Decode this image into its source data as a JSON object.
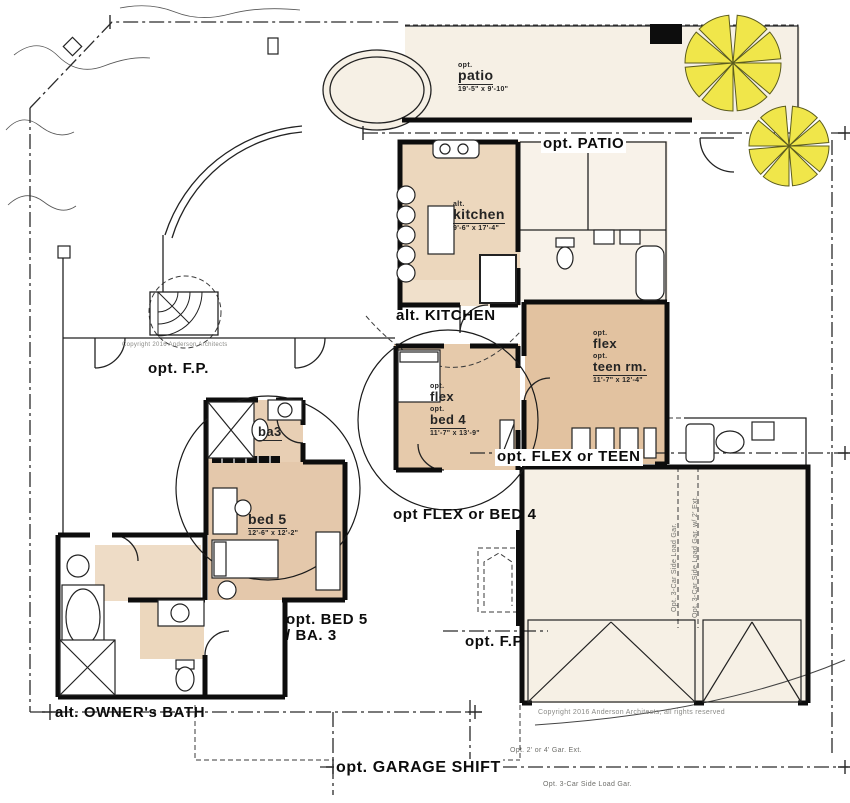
{
  "colors": {
    "tan": "#e4c8ab",
    "tan_light": "#eedcc6",
    "cream": "#f6f0e5",
    "line": "#111111",
    "tree_yellow": "#f0e64a",
    "note_gray": "#8a8a86"
  },
  "rooms": {
    "patio": {
      "prefix": "opt.",
      "name": "patio",
      "dims": "19'-5\" x 9'-10\""
    },
    "kitchen": {
      "prefix": "alt.",
      "name": "kitchen",
      "dims": "9'-6\" x 17'-4\""
    },
    "flex_teen": {
      "prefix1": "opt.",
      "line1": "flex",
      "prefix2": "opt.",
      "line2": "teen rm.",
      "dims": "11'-7\" x 12'-4\""
    },
    "flex_bed4": {
      "prefix1": "opt.",
      "line1": "flex",
      "prefix2": "opt.",
      "line2": "bed 4",
      "dims": "11'-7\" x 13'-9\""
    },
    "ba3": {
      "name": "ba3"
    },
    "bed5": {
      "name": "bed 5",
      "dims": "12'-6\" x 12'-2\""
    }
  },
  "callouts": {
    "patio": "opt. PATIO",
    "kitchen": "alt. KITCHEN",
    "fp_left": "opt. F.P.",
    "flex_teen": "opt. FLEX or TEEN",
    "flex_bed4": "opt FLEX or BED 4",
    "bed5_line1": "opt. BED 5",
    "bed5_line2": "/ BA. 3",
    "owners_bath": "alt. OWNER's BATH",
    "fp_bottom": "opt. F.P.",
    "garage_shift": "opt. GARAGE SHIFT"
  },
  "notes": {
    "copyright_small": "Copyright 2016 Anderson Architects",
    "copyright_garage": "Copyright 2016 Anderson Architects, all rights reserved",
    "gar_ext": "Opt. 2' or 4' Gar. Ext.",
    "side_load_bottom": "Opt. 3-Car Side Load Gar.",
    "side_load_v1": "Opt. 3-Car Side Load Gar.",
    "side_load_v2": "Opt. 3-Car Side Load Gar. w/ 2' Ext."
  }
}
